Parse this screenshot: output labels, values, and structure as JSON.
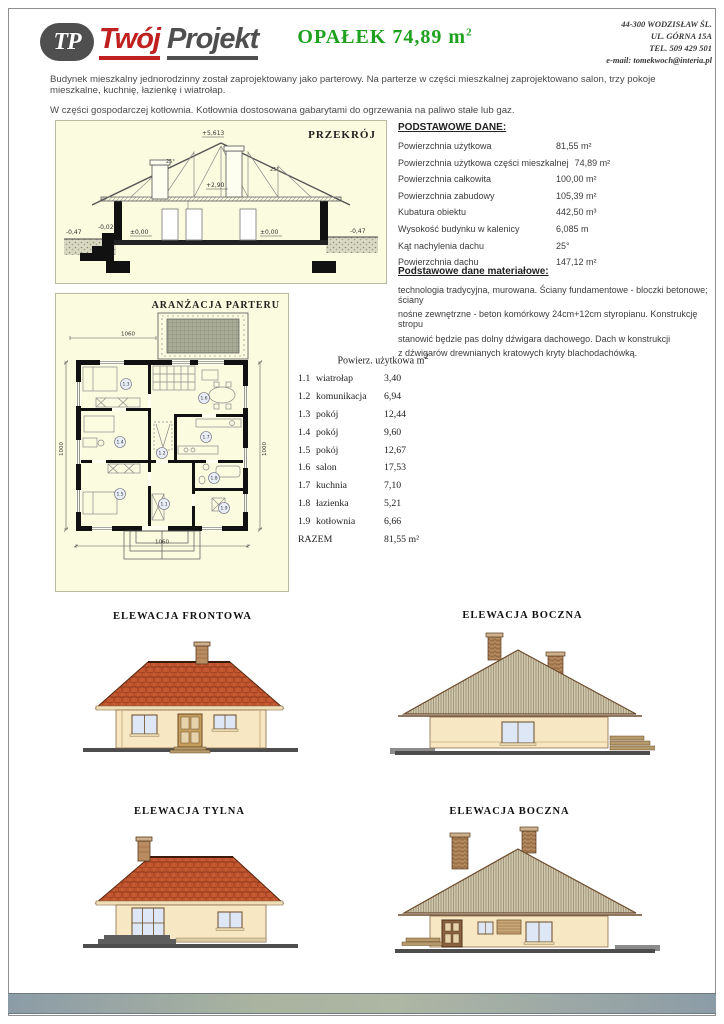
{
  "colors": {
    "accent_green": "#1fa11f",
    "logo_red": "#c02020",
    "logo_gray": "#4f4f4f",
    "panel_cream": "#fbfbdf",
    "roof_tile": "#c0532c",
    "gable_siding": "#cfc6ab",
    "wall_cream": "#f7e7c3",
    "window_glass": "#dee7f6",
    "footer_gray_blue": "#8c9ca7",
    "footer_gray_green": "#a9b3a0"
  },
  "header": {
    "logo": {
      "monogram": "TP",
      "word1": "Twój",
      "word2": "Projekt"
    },
    "title_main": "OPAŁEK  74,89 m",
    "title_sup": "2",
    "contact_lines": [
      "44-300 WODZISŁAW ŚL.",
      "UL. GÓRNA 15A",
      "TEL. 509 429 501",
      "e-mail: tomekwoch@interia.pl"
    ]
  },
  "intro": {
    "line1": "Budynek mieszkalny jednorodzinny został zaprojektowany jako parterowy. Na parterze w części mieszkalnej zaprojektowano salon, trzy pokoje mieszkalne, kuchnię, łazienkę i wiatrołap.",
    "line2": "W części gospodarczej  kotłownia. Kotłownia dostosowana gabarytami do ogrzewania na paliwo stałe lub gaz."
  },
  "cross_section": {
    "title": "PRZEKRÓJ",
    "labels": {
      "ridge": "+5,613",
      "ceiling": "+2,90",
      "floor": "±0,00",
      "floor_minus": "-0,02",
      "ground": "-0,47",
      "angle": "25°"
    }
  },
  "basic_data": {
    "heading": "PODSTAWOWE DANE:",
    "rows": [
      {
        "label": "Powierzchnia użytkowa",
        "value": "81,55 m²"
      },
      {
        "label": "Powierzchnia użytkowa części mieszkalnej",
        "value": "74,89 m²"
      },
      {
        "label": "Powierzchnia całkowita",
        "value": "100,00 m²"
      },
      {
        "label": "Powierzchnia zabudowy",
        "value": "105,39 m²"
      },
      {
        "label": "Kubatura obiektu",
        "value": "442,50 m³"
      },
      {
        "label": "Wysokość budynku w kalenicy",
        "value": "6,085 m"
      },
      {
        "label": "Kąt nachylenia dachu",
        "value": "25°"
      },
      {
        "label": "Powierzchnia dachu",
        "value": "147,12 m²"
      }
    ]
  },
  "materials": {
    "heading": "Podstawowe dane materiałowe:",
    "lines": [
      "technologia tradycyjna, murowana. Ściany fundamentowe - bloczki betonowe; ściany",
      "nośne zewnętrzne - beton komórkowy 24cm+12cm styropianu.   Konstrukcję stropu",
      "stanowić będzie pas dolny dźwigara dachowego.   Dach w konstrukcji",
      "z dźwigarów drewnianych kratowych   kryty blachodachówką."
    ]
  },
  "floor_plan": {
    "title": "ARANŻACJA  PARTERU",
    "dim_width": "1060",
    "dim_depth": "1000",
    "room_labels": {
      "r13": "1.3",
      "r16": "1.6",
      "r14": "1.4",
      "r17": "1.7",
      "r12": "1.2",
      "r18": "1.8",
      "r15": "1.5",
      "r11": "1.1",
      "r19": "1.9"
    }
  },
  "rooms": {
    "heading": "Powierz. użytkowa m",
    "heading_sup": "2",
    "rows": [
      {
        "no": "1.1",
        "name": "wiatrołap",
        "area": "3,40"
      },
      {
        "no": "1.2",
        "name": "komunikacja",
        "area": "6,94"
      },
      {
        "no": "1.3",
        "name": "pokój",
        "area": "12,44"
      },
      {
        "no": "1.4",
        "name": "pokój",
        "area": "9,60"
      },
      {
        "no": "1.5",
        "name": "pokój",
        "area": "12,67"
      },
      {
        "no": "1.6",
        "name": "salon",
        "area": "17,53"
      },
      {
        "no": "1.7",
        "name": "kuchnia",
        "area": "7,10"
      },
      {
        "no": "1.8",
        "name": "łazienka",
        "area": "5,21"
      },
      {
        "no": "1.9",
        "name": "kotłownia",
        "area": "6,66"
      }
    ],
    "total_label": "RAZEM",
    "total_value": "81,55 m²"
  },
  "elevations": {
    "front": "ELEWACJA  FRONTOWA",
    "side1": "ELEWACJA BOCZNA",
    "rear": "ELEWACJA  TYLNA",
    "side2": "ELEWACJA BOCZNA"
  }
}
